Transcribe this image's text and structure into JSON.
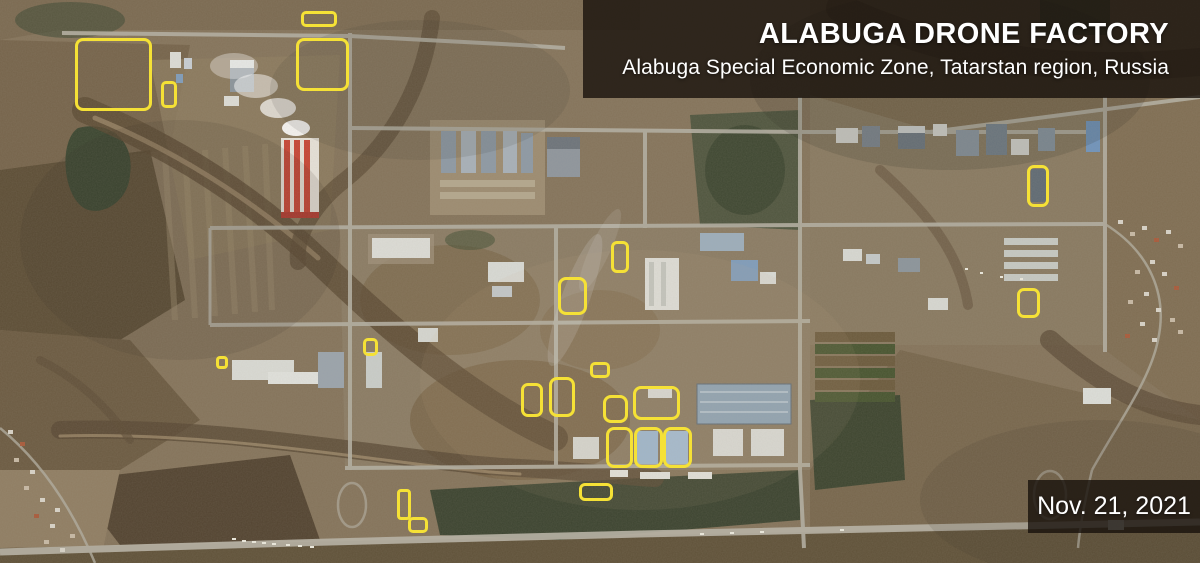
{
  "header": {
    "title": "ALABUGA DRONE FACTORY",
    "subtitle": "Alabuga Special Economic Zone, Tatarstan region, Russia"
  },
  "date_label": "Nov. 21, 2021",
  "colors": {
    "annotation_yellow": "#F5E136",
    "overlay_background": "rgba(22,16,10,0.78)",
    "overlay_text": "#FFFFFF"
  },
  "annotations": {
    "boxes": [
      {
        "id": "nw-large",
        "x": 75,
        "y": 38,
        "w": 77,
        "h": 73
      },
      {
        "id": "nw-small",
        "x": 161,
        "y": 81,
        "w": 16,
        "h": 27
      },
      {
        "id": "n-top",
        "x": 301,
        "y": 11,
        "w": 36,
        "h": 16
      },
      {
        "id": "n-large",
        "x": 296,
        "y": 38,
        "w": 53,
        "h": 53
      },
      {
        "id": "center-tall",
        "x": 611,
        "y": 241,
        "w": 18,
        "h": 32
      },
      {
        "id": "center-mid",
        "x": 558,
        "y": 277,
        "w": 29,
        "h": 38
      },
      {
        "id": "west-small",
        "x": 216,
        "y": 356,
        "w": 12,
        "h": 13
      },
      {
        "id": "west-mid",
        "x": 363,
        "y": 338,
        "w": 15,
        "h": 18
      },
      {
        "id": "center-small",
        "x": 590,
        "y": 362,
        "w": 20,
        "h": 16
      },
      {
        "id": "cluster-1",
        "x": 521,
        "y": 383,
        "w": 22,
        "h": 34
      },
      {
        "id": "cluster-2",
        "x": 549,
        "y": 377,
        "w": 26,
        "h": 40
      },
      {
        "id": "cluster-3",
        "x": 603,
        "y": 395,
        "w": 25,
        "h": 28
      },
      {
        "id": "cluster-4",
        "x": 633,
        "y": 386,
        "w": 47,
        "h": 34
      },
      {
        "id": "cluster-5",
        "x": 606,
        "y": 427,
        "w": 27,
        "h": 41
      },
      {
        "id": "cluster-6",
        "x": 634,
        "y": 427,
        "w": 29,
        "h": 41
      },
      {
        "id": "cluster-7",
        "x": 663,
        "y": 427,
        "w": 29,
        "h": 41
      },
      {
        "id": "south-tall",
        "x": 397,
        "y": 489,
        "w": 14,
        "h": 31
      },
      {
        "id": "south-small",
        "x": 408,
        "y": 517,
        "w": 20,
        "h": 16
      },
      {
        "id": "south-wide",
        "x": 579,
        "y": 483,
        "w": 34,
        "h": 18
      },
      {
        "id": "east-tall",
        "x": 1027,
        "y": 165,
        "w": 22,
        "h": 42
      },
      {
        "id": "east-small",
        "x": 1017,
        "y": 288,
        "w": 23,
        "h": 30
      }
    ]
  }
}
